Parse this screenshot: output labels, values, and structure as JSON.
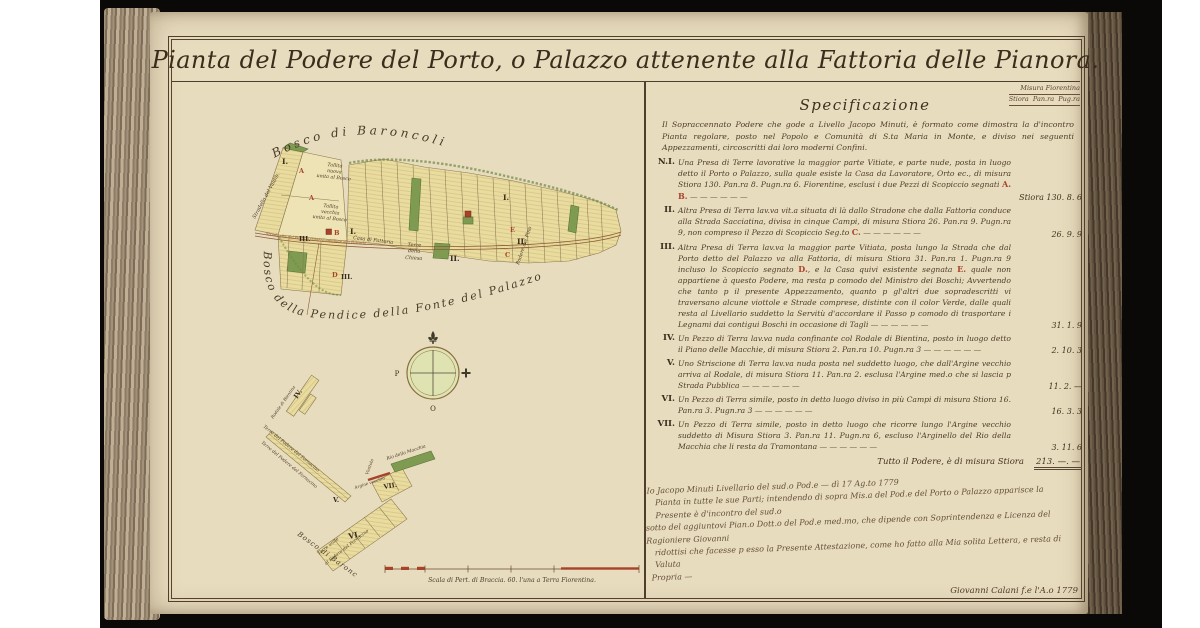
{
  "page": {
    "title": "Pianta del Podere del Porto, o Palazzo attenente alla Fattoria delle Pianora."
  },
  "spec": {
    "corner_line1": "Misura Fiorentina",
    "corner_line2": "Stiora  Pan.ra  Pug.ra",
    "heading": "Specificazione",
    "intro": "Il Sopraccennato Podere che gode a Livello Jacopo Minuti, è formato come dimostra la d'incontro Pianta regolare, posto nel Popolo e Comunità di S.ta Maria in Monte, e diviso nei seguenti Appezzamenti, circoscritti dai loro moderni Confini.",
    "entries": [
      {
        "num": "N.I.",
        "body1": "Una Presa di Terre lavorative la maggior parte Vitiate, e parte nude, posta in luogo detto il Porto o Palazzo, sulla quale esiste la Casa da Lavoratore, Orto ec., di misura Stiora 130. Pan.ra 8. Pugn.ra 6. Fiorentine, esclusi i due Pezzi di Scopiccio segnati ",
        "mark1": "A. B.",
        "value": "Stiora 130. 8. 6"
      },
      {
        "num": "II.",
        "body1": "Altra Presa di Terra lav.va vit.a situata di là dallo Stradone che dalla Fattoria conduce alla Strada Sacciatina, divisa in cinque Campi, di misura Stiora 26. Pan.ra 9. Pugn.ra 9, non compreso il Pezzo di Scopiccio Seg.to ",
        "mark1": "C.",
        "value": "26. 9. 9"
      },
      {
        "num": "III.",
        "body1": "Altra Presa di Terra lav.va la maggior parte Vitiata, posta lungo la Strada che dal Porto detto del Palazzo va alla Fattoria, di misura Stiora 31. Pan.ra 1. Pugn.ra 9 incluso lo Scopiccio segnato ",
        "mark1": "D.",
        "body2": ", e la Casa quivi esistente segnata ",
        "mark2": "E.",
        "body3": " quale non appartiene à questo Podere, ma resta p comodo del Ministro dei Boschi; Avvertendo che tanto p il presente Appezzamento, quanto p gl'altri due sopradescritti vi traversano alcune viottole e Strade comprese, distinte con il color Verde, dalle quali resta al Livellario suddetto la Servitù d'accordare il Passo p comodo di trasportare i Legnami dai contigui Boschi in occasione di Tagli",
        "value": "31. 1. 9"
      },
      {
        "num": "IV.",
        "body1": "Un Pezzo di Terra lav.va nuda confinante col Rodale di Bientina, posto in luogo detto il Piano delle Macchie, di misura Stiora 2. Pan.ra 10. Pugn.ra 3",
        "value": "2. 10. 3"
      },
      {
        "num": "V.",
        "body1": "Uno Striscione di Terra lav.va nuda posta nel suddetto luogo, che dall'Argine vecchio arriva al Rodale, di misura Stiora 11. Pan.ra 2. esclusa l'Argine med.o che si lascia p Strada Pubblica",
        "value": "11. 2. —"
      },
      {
        "num": "VI.",
        "body1": "Un Pezzo di Terra simile, posto in detto luogo diviso in più Campi di misura Stiora 16. Pan.ra 3. Pugn.ra 3",
        "value": "16. 3. 3"
      },
      {
        "num": "VII.",
        "body1": "Un Pezzo di Terra simile, posto in detto luogo che ricorre lungo l'Argine vecchio suddetto di Misura Stiora 3. Pan.ra 11. Pugn.ra 6, escluso l'Arginello del Rio della Macchia che li resta da Tramontana",
        "value": "3. 11. 6"
      }
    ],
    "total_label": "Tutto il Podere, è di misura Stiora",
    "total_value": "213. —. —",
    "attestation": [
      "Io Jacopo Minuti Livellario del sud.o Pod.e — dì 17 Ag.to 1779",
      "Pianta in tutte le sue Parti; intendendo di sopra Mis.a del Pod.e del Porto o Palazzo apparisce la Presente è d'incontro del sud.o",
      "sotto del aggiuntovi Pian.o Dott.o del Pod.e med.mo, che dipende con Soprintendenza e Licenza del Ragioniere Giovanni",
      "ridottisi che facesse p esso la Presente Attestazione, come ho fatto alla Mia solita Lettera, e resta di Valuta",
      "Propria —"
    ],
    "signature": "Giovanni Calani f.e l'A.o 1779"
  },
  "map": {
    "arcs": {
      "bosco_top": "Bosco  di  Baroncoli",
      "bosco_pendice": "Bosco della Pendice della Fonte del Palazzo"
    },
    "labels": {
      "stradello": "Stradello del Valdib.",
      "tallita_nuova": "Tallita\nnuova\nunita al Bosco",
      "tallita_vecchia": "Tallita\nvecchia\nunita al Bosco",
      "casa_fattoria": "Casa di Fattoria",
      "terre_chiesa": "Terre\ndella\nChiesa",
      "podere_pino": "Podere del Pino",
      "strada": "Strada che dal Porto o Palazzo conduce alla Fattoria",
      "terre_fornacino": "Terre del Podere del Fornacino",
      "terre_unite_1": "Terre unite",
      "terre_unite_2": "al Podere del Fornacino",
      "bosco_basso": "Bosco di Baroncoli",
      "rio_macchia": "Rio della Macchia",
      "argine": "Argine vecchio",
      "viottola": "Viottola",
      "rodale": "Rodale di Bientina"
    },
    "numerals": {
      "i": "I.",
      "ii": "II.",
      "iii": "III.",
      "iv": "IV.",
      "v": "V.",
      "vi": "VI.",
      "vii": "VII."
    },
    "letters": {
      "a": "A",
      "b": "B",
      "c": "C",
      "d": "D",
      "e": "E"
    },
    "compass": {
      "west": "P",
      "south": "O"
    },
    "scale_caption": "Scala di Pert. di Braccia. 60. l'una a Terra Fiorentina.",
    "colors": {
      "parcel": "#eadc9f",
      "green": "#7e9b51",
      "red": "#a8432a",
      "ink": "#4a3a28"
    }
  }
}
